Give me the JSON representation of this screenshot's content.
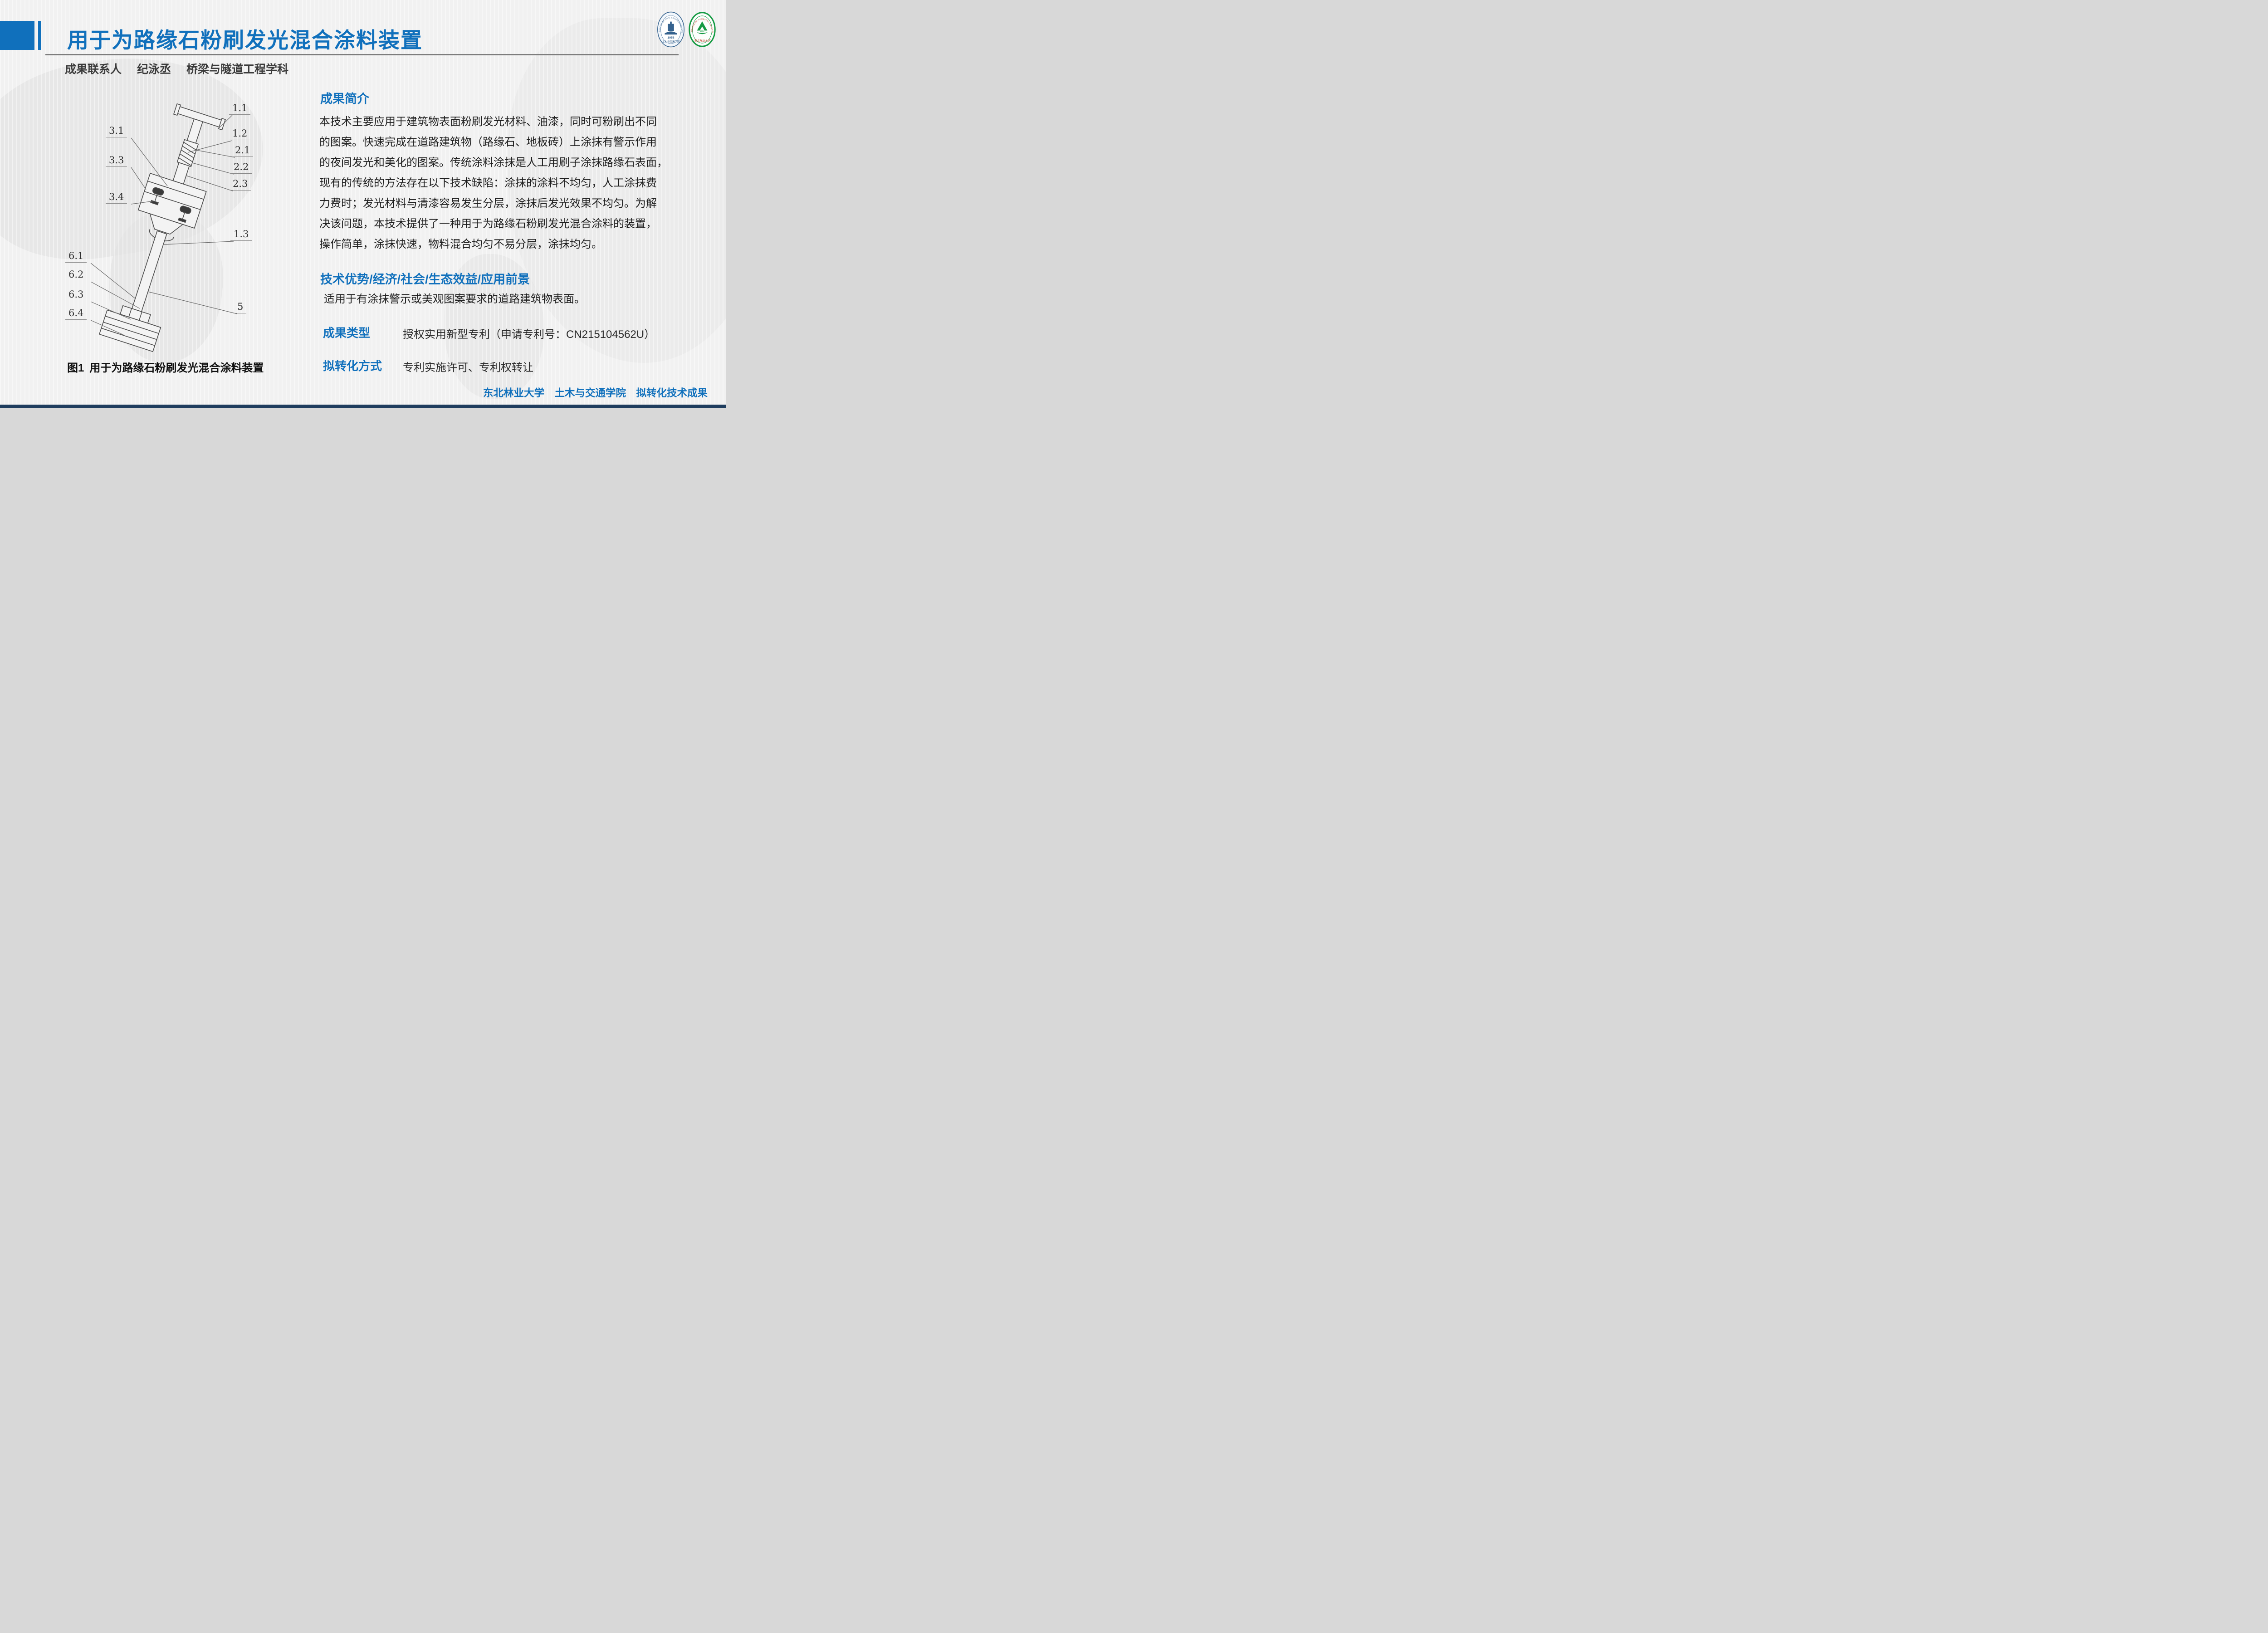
{
  "slide": {
    "header": {
      "title": "用于为路缘石粉刷发光混合涂料装置",
      "contact_label": "成果联系人",
      "contact_name": "纪泳丞",
      "contact_dept": "桥梁与隧道工程学科"
    },
    "figure": {
      "caption_prefix": "图1",
      "caption_text": "用于为路缘石粉刷发光混合涂料装置",
      "part_labels": [
        "1.1",
        "1.2",
        "2.1",
        "2.2",
        "2.3",
        "1.3",
        "5",
        "3.1",
        "3.3",
        "3.4",
        "6.1",
        "6.2",
        "6.3",
        "6.4"
      ]
    },
    "intro": {
      "heading": "成果简介",
      "lines": [
        "本技术主要应用于建筑物表面粉刷发光材料、油漆，同时可粉刷出不同",
        "的图案。快速完成在道路建筑物（路缘石、地板砖）上涂抹有警示作用",
        "的夜间发光和美化的图案。传统涂料涂抹是人工用刷子涂抹路缘石表面，",
        "现有的传统的方法存在以下技术缺陷：涂抹的涂料不均匀，人工涂抹费",
        "力费时；发光材料与清漆容易发生分层，涂抹后发光效果不均匀。为解",
        "决该问题，本技术提供了一种用于为路缘石粉刷发光混合涂料的装置，",
        "操作简单，涂抹快速，物料混合均匀不易分层，涂抹均匀。"
      ]
    },
    "benefits": {
      "heading": "技术优势/经济/社会/生态效益/应用前景",
      "body": "适用于有涂抹警示或美观图案要求的道路建筑物表面。"
    },
    "result_type": {
      "label": "成果类型",
      "value": "授权实用新型专利（申请专利号：CN215104562U）"
    },
    "transfer": {
      "label": "拟转化方式",
      "value": "专利实施许可、专利权转让"
    },
    "footer": {
      "text": "东北林业大学　土木与交通学院　拟转化技术成果"
    },
    "logos": {
      "college": {
        "ring_text": "SCHOOL OF CIVIL ENGINEERING AND TRANSPORTATION",
        "year": "1958",
        "name": "土木与交通学院"
      },
      "university": {
        "ring_text": "NORTHEAST FORESTRY UNIVERSITY",
        "year": "1952",
        "name": "东北林业大学"
      }
    },
    "colors": {
      "accent": "#1070bc",
      "text_dark": "#1e1e1e",
      "rule_gray": "#7d7d7d",
      "bottom_bar": "#1f3d5e",
      "college_logo": "#35628e",
      "university_logo": "#159a43",
      "university_text_red": "#c0392b"
    }
  }
}
